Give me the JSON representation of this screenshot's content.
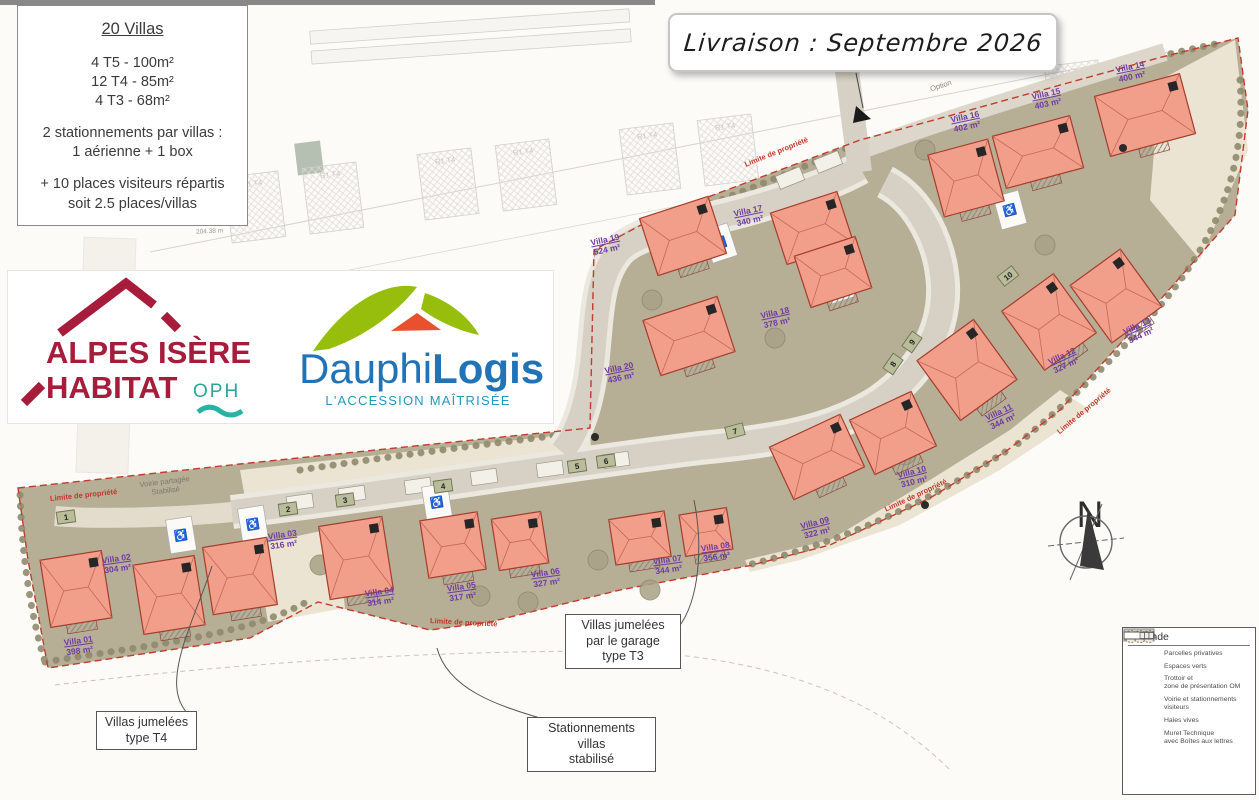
{
  "info_box": {
    "title": "20 Villas",
    "units": [
      "4 T5 - 100m²",
      "12 T4 - 85m²",
      "4 T3 - 68m²"
    ],
    "parking": [
      "2 stationnements par villas :",
      "1 aérienne + 1 box"
    ],
    "visitors": [
      "+ 10 places visiteurs répartis",
      "soit 2.5 places/villas"
    ]
  },
  "banner": {
    "text": "Livraison : Septembre 2026"
  },
  "logos": {
    "alpes_isere_habitat": {
      "line1": "ALPES ISÈRE",
      "line2": "HABITAT",
      "suffix": "OPH",
      "brand_red": "#a61c3a",
      "brand_teal": "#27a69a"
    },
    "dauphilogis": {
      "name_part1": "Dauphi",
      "name_part2": "Logis",
      "tagline": "L'ACCESSION MAÎTRISÉE",
      "brand_blue": "#2173b8",
      "brand_green": "#97be0d",
      "brand_orange": "#e8502e",
      "brand_teal": "#2596be"
    }
  },
  "legend": {
    "title": "Légende",
    "items": [
      {
        "label1": "Parcelles privatives",
        "label2": ""
      },
      {
        "label1": "Espaces verts",
        "label2": ""
      },
      {
        "label1": "Trottoir et",
        "label2": "zone de présentation OM"
      },
      {
        "label1": "Voirie et stationnements",
        "label2": "visiteurs"
      },
      {
        "label1": "Haies vives",
        "label2": ""
      },
      {
        "label1": "Muret Technique",
        "label2": "avec Boîtes aux lettres"
      }
    ]
  },
  "callouts": {
    "t3": {
      "lines": [
        "Villas jumelées",
        "par le garage",
        "type T3"
      ]
    },
    "t4": {
      "lines": [
        "Villas jumelées",
        "type T4"
      ]
    },
    "stab": {
      "lines": [
        "Stationnements villas",
        "stabilisé"
      ]
    }
  },
  "compass": {
    "label": "N"
  },
  "map_labels": {
    "limite": "Limite de propriété",
    "voirie_line1": "Voirie partagée",
    "voirie_line2": "Stabilisé",
    "option": "Option",
    "dim": "204.38 m"
  },
  "background": {
    "plot_label": "R1 T4"
  },
  "markers": [
    "1",
    "2",
    "3",
    "4",
    "5",
    "6",
    "7",
    "8",
    "9",
    "10"
  ],
  "villas": [
    {
      "name": "Villa 01",
      "area": "398 m²"
    },
    {
      "name": "Villa 02",
      "area": "304 m²"
    },
    {
      "name": "Villa 03",
      "area": "316 m²"
    },
    {
      "name": "Villa 04",
      "area": "314 m²"
    },
    {
      "name": "Villa 05",
      "area": "317 m²"
    },
    {
      "name": "Villa 06",
      "area": "327 m²"
    },
    {
      "name": "Villa 07",
      "area": "344 m²"
    },
    {
      "name": "Villa 08",
      "area": "356 m²"
    },
    {
      "name": "Villa 09",
      "area": "322 m²"
    },
    {
      "name": "Villa 10",
      "area": "310 m²"
    },
    {
      "name": "Villa 11",
      "area": "344 m²"
    },
    {
      "name": "Villa 12",
      "area": "327 m²"
    },
    {
      "name": "Villa 13",
      "area": "344 m²"
    },
    {
      "name": "Villa 14",
      "area": "400 m²"
    },
    {
      "name": "Villa 15",
      "area": "403 m²"
    },
    {
      "name": "Villa 16",
      "area": "402 m²"
    },
    {
      "name": "Villa 17",
      "area": "340 m²"
    },
    {
      "name": "Villa 18",
      "area": "378 m²"
    },
    {
      "name": "Villa 19",
      "area": "524 m²"
    },
    {
      "name": "Villa 20",
      "area": "436 m²"
    }
  ],
  "colors": {
    "villa_fill": "#f19e8b",
    "villa_stroke": "#a63c2c",
    "espaces_verts": "#b7ae96",
    "parcelle": "#ece4d2",
    "voirie": "#d7d1c5",
    "boundary_red": "#c43b2e",
    "villa_label": "#6f3aa5",
    "marker_green": "#b9bd9a"
  }
}
